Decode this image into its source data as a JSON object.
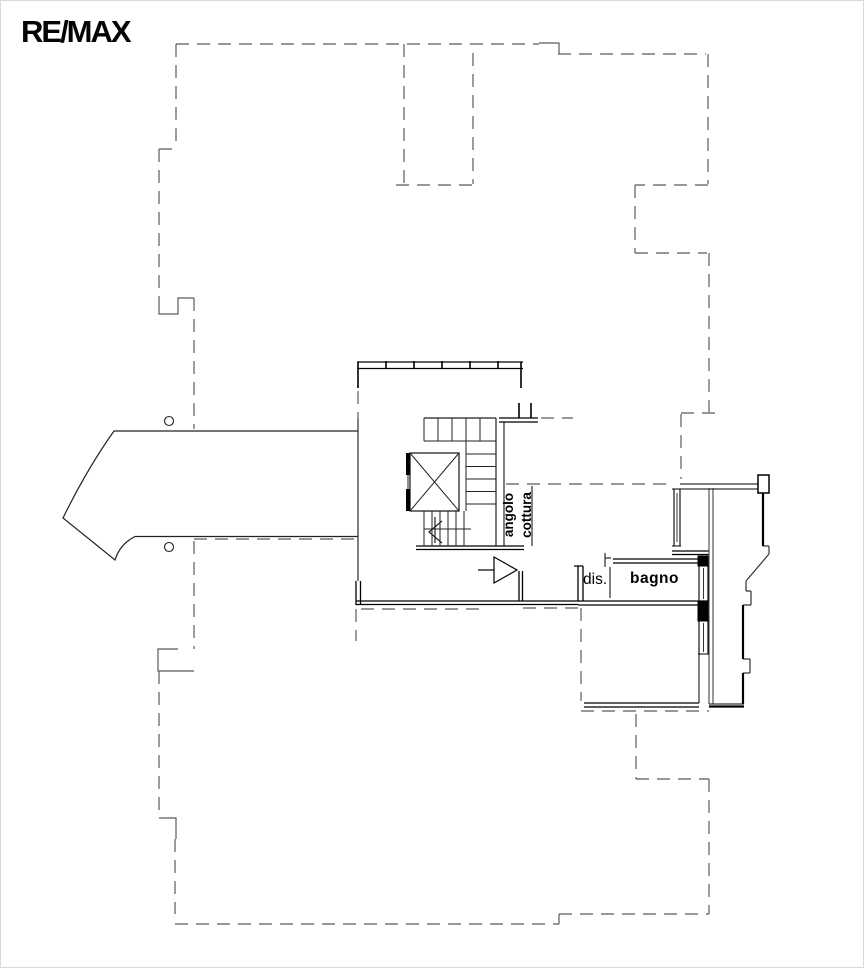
{
  "brand": {
    "logo": "RE/MAX"
  },
  "labels": {
    "kitchen": "angolo\ncottura",
    "hallway": "dis.",
    "bathroom": "bagno"
  },
  "colors": {
    "background": "#ffffff",
    "walls": "#000000",
    "stairs": "#222222",
    "outline_dashed": "#5b5b5b",
    "logo": "#000000"
  }
}
